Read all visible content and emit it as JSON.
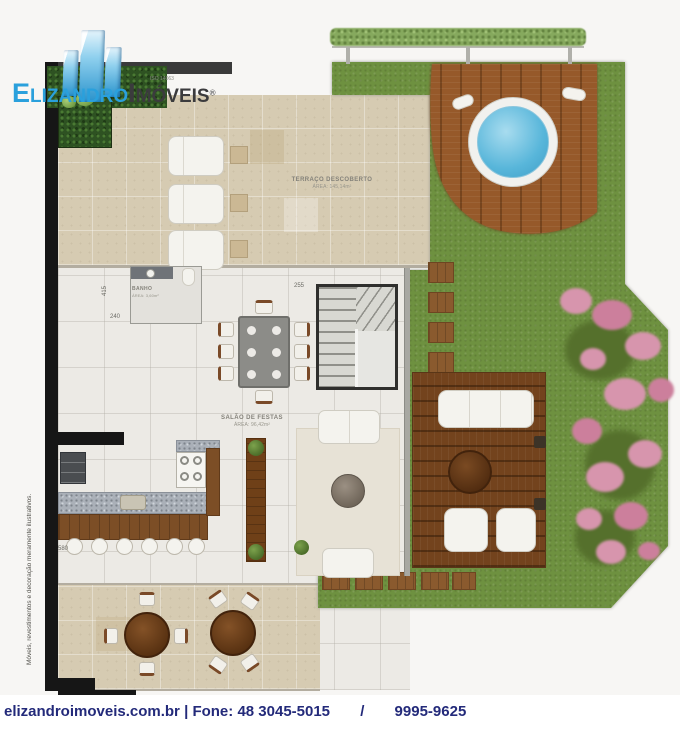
{
  "logo": {
    "brand_primary": "Elizandro",
    "brand_secondary": "Imóveis",
    "registered": "®",
    "tagline": "ISO 14063"
  },
  "plan": {
    "labels": {
      "terraco": {
        "title": "TERRAÇO DESCOBERTO",
        "area": "ÁREA: 145,14m²"
      },
      "salao": {
        "title": "SALÃO DE FESTAS",
        "area": "ÁREA: 96,42m²"
      },
      "banho": {
        "title": "BANHO",
        "area": "ÁREA: 3,60m²"
      }
    },
    "dimensions": {
      "d1": "415",
      "d2": "240",
      "d3": "255",
      "d4": "580"
    },
    "disclaimer": "Móveis, revestimentos e decoração meramente ilustrativos."
  },
  "footer": {
    "site": "elizandroimoveis.com.br",
    "separator": "|",
    "phone_label": "Fone:",
    "phone_primary": "48 3045-5015",
    "slash": "/",
    "phone_secondary": "9995-9625"
  },
  "colors": {
    "grass": "#6e9140",
    "deck": "#96592a",
    "deck-dark": "#73431d",
    "pool": "#58b6da",
    "stone": "#d6cbb2",
    "salon": "#eceae5",
    "flower": "#d795ad",
    "wood-furniture": "#6f4018",
    "logo-blue": "#2aa0dc",
    "logo-dark": "#3b3b3d",
    "footer-navy": "#232a7a",
    "wall-black": "#161616"
  }
}
